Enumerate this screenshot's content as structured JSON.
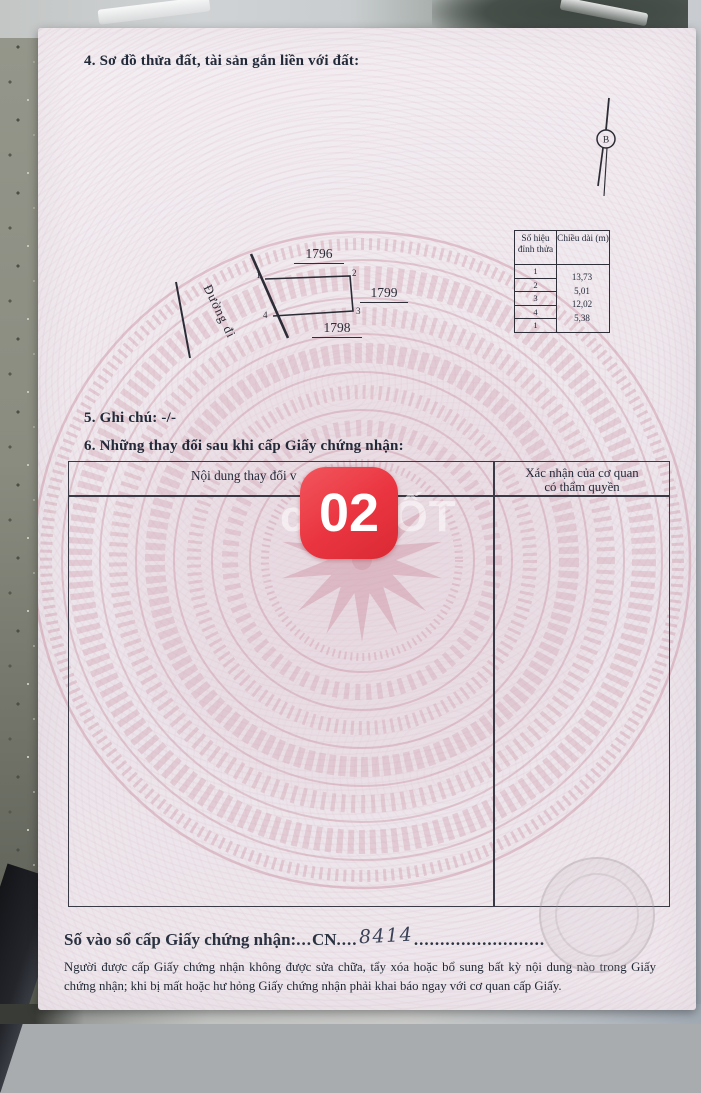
{
  "sections": {
    "s4_title": "4. Sơ đồ thửa đất, tài sản gắn liền với đất:",
    "s5_title": "5. Ghi chú: -/-",
    "s6_title": "6. Những thay đổi sau khi cấp Giấy chứng nhận:"
  },
  "north_arrow": {
    "label": "B"
  },
  "plot_diagram": {
    "road_label": "Đường đi",
    "parcel_number_top": "1796",
    "parcel_number_right": "1799",
    "parcel_number_bottom": "1798",
    "vertex_labels": [
      "1",
      "2",
      "3",
      "4"
    ]
  },
  "vertex_table": {
    "col1_header": "Số hiệu đỉnh thửa",
    "col2_header": "Chiều dài (m)",
    "vertex_ids": [
      "1",
      "2",
      "3",
      "4",
      "1"
    ],
    "lengths_m": [
      "13,73",
      "5,01",
      "12,02",
      "5,38"
    ]
  },
  "changes_table": {
    "col1_header_visible": "Nội dung thay đổi v",
    "col2_header_line1": "Xác nhận của cơ quan",
    "col2_header_line2": "có thẩm quyền"
  },
  "overlays": {
    "sticker_number": "02",
    "sticker_color": "#ea3540",
    "watermark": "chợTỐT"
  },
  "registry_line": {
    "label": "Số vào sổ cấp Giấy chứng nhận:",
    "dots1": "...",
    "code": "CN",
    "dots2": "....",
    "number_handwritten": "8414",
    "dots3": "........................."
  },
  "notice_text": "Người được cấp Giấy chứng nhận không được sửa chữa, tẩy xóa hoặc bổ sung bất kỳ nội dung nào trong Giấy chứng nhận; khi bị mất hoặc hư hỏng Giấy chứng nhận phải khai báo ngay với cơ quan cấp Giấy."
}
